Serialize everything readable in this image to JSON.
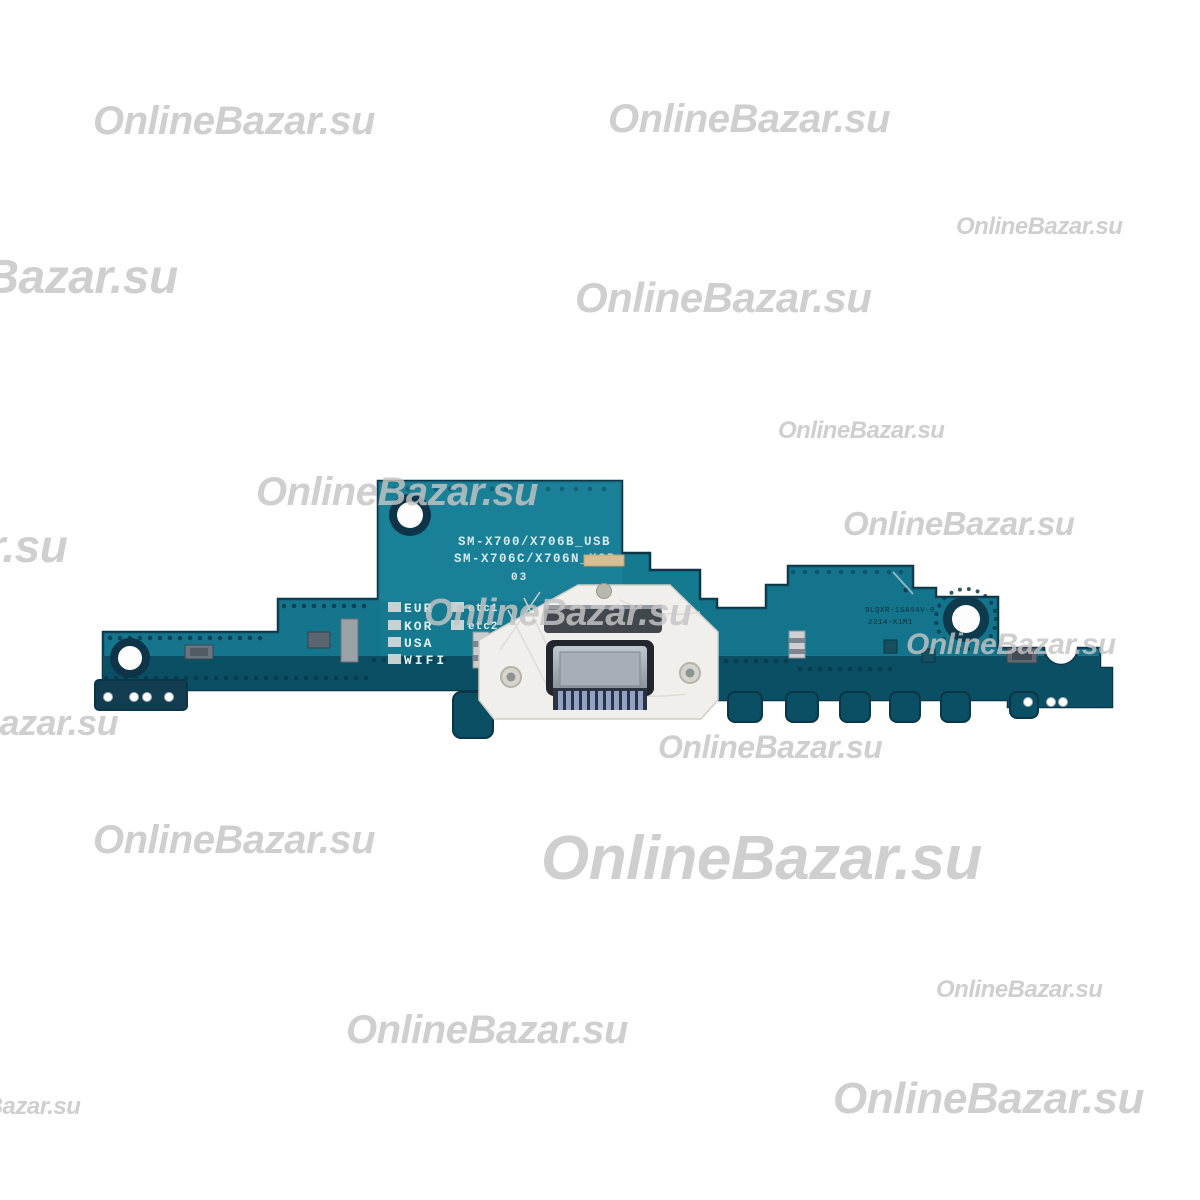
{
  "watermark": {
    "text": "OnlineBazar.su",
    "color": "#cfcfcf",
    "instances": [
      {
        "x": 93,
        "y": 101,
        "size": 40
      },
      {
        "x": 608,
        "y": 99,
        "size": 40
      },
      {
        "x": 956,
        "y": 215,
        "size": 24
      },
      {
        "x": -162,
        "y": 254,
        "size": 48
      },
      {
        "x": 575,
        "y": 277,
        "size": 42
      },
      {
        "x": 778,
        "y": 419,
        "size": 24
      },
      {
        "x": 256,
        "y": 472,
        "size": 40
      },
      {
        "x": -258,
        "y": 523,
        "size": 46
      },
      {
        "x": 843,
        "y": 507,
        "size": 33
      },
      {
        "x": 424,
        "y": 594,
        "size": 38
      },
      {
        "x": 906,
        "y": 630,
        "size": 30
      },
      {
        "x": -135,
        "y": 705,
        "size": 36
      },
      {
        "x": 658,
        "y": 731,
        "size": 32
      },
      {
        "x": 93,
        "y": 820,
        "size": 40
      },
      {
        "x": 541,
        "y": 828,
        "size": 62
      },
      {
        "x": -302,
        "y": 974,
        "size": 40
      },
      {
        "x": 936,
        "y": 978,
        "size": 24
      },
      {
        "x": 346,
        "y": 1010,
        "size": 40
      },
      {
        "x": 833,
        "y": 1077,
        "size": 44
      },
      {
        "x": -86,
        "y": 1095,
        "size": 24
      }
    ]
  },
  "board": {
    "silkscreen": {
      "model_line1": "SM-X700/X706B_USB",
      "model_line2": "SM-X706C/X706N_USB",
      "revision": "03",
      "regions": [
        {
          "label": "EUR",
          "suffix": "etc1"
        },
        {
          "label": "KOR",
          "suffix": "etc2"
        },
        {
          "label": "USA",
          "suffix": ""
        },
        {
          "label": "WIFI",
          "suffix": ""
        }
      ],
      "right_marking_line1": "9LQXR-1SA94V-0",
      "right_marking_line2": "2214-K1M1"
    },
    "colors": {
      "pcb_teal": "#15798f",
      "pcb_center_highlight": "#1f8aa2",
      "pcb_bottom_band": "#0a4f63",
      "pcb_edge": "#0b3647",
      "bracket_white": "#f0efeb",
      "connector_metal": "#9aa3ad",
      "connector_pins": "#93a2c4",
      "gold_pad": "#d9bd92"
    }
  }
}
